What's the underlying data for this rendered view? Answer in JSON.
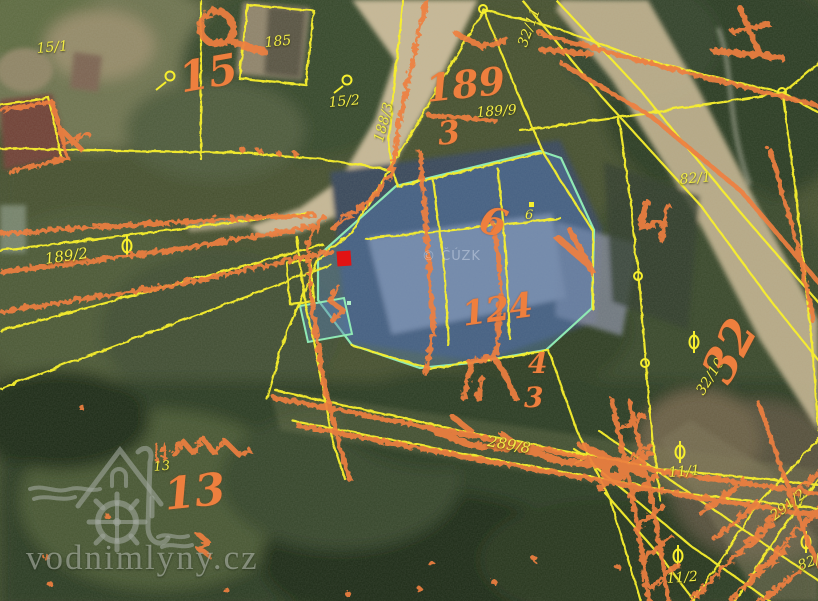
{
  "app": {
    "type": "aerial-cadastral-map-view",
    "watermark_site": "vodnimlyny.cz",
    "copyright": "© ČÚZK"
  },
  "colors": {
    "parcel_line_yellow": "#f7ef2e",
    "sketch_orange": "#ee7f40",
    "highlight_fill": "rgba(88,128,180,0.45)",
    "highlight_outline": "#8fe9b4",
    "marker_red": "#e11313",
    "road_tan": "#c6b795",
    "forest_green": "#2c3a20",
    "watermark_gray": "rgba(160,166,156,0.6)"
  },
  "marker": {
    "x": 337,
    "y": 251,
    "w": 14,
    "h": 15
  },
  "parcel_labels": [
    {
      "text": "15/1",
      "x": 36,
      "y": 42,
      "size": 14,
      "rot": -5
    },
    {
      "text": "185",
      "x": 264,
      "y": 36,
      "size": 14,
      "rot": -5
    },
    {
      "text": "15/2",
      "x": 328,
      "y": 96,
      "size": 14,
      "rot": -5
    },
    {
      "text": "188/3",
      "x": 372,
      "y": 140,
      "size": 14,
      "rot": -75
    },
    {
      "text": "189/9",
      "x": 476,
      "y": 106,
      "size": 14,
      "rot": -4
    },
    {
      "text": "189/2",
      "x": 44,
      "y": 252,
      "size": 15,
      "rot": -8
    },
    {
      "text": "82/1",
      "x": 679,
      "y": 173,
      "size": 14,
      "rot": -5
    },
    {
      "text": "32/11",
      "x": 516,
      "y": 44,
      "size": 14,
      "rot": -70
    },
    {
      "text": "32/10",
      "x": 694,
      "y": 390,
      "size": 14,
      "rot": -58
    },
    {
      "text": "11/1",
      "x": 668,
      "y": 466,
      "size": 14,
      "rot": -4
    },
    {
      "text": "11/2",
      "x": 666,
      "y": 572,
      "size": 14,
      "rot": -4
    },
    {
      "text": "291/2",
      "x": 768,
      "y": 512,
      "size": 14,
      "rot": -38
    },
    {
      "text": "289/8",
      "x": 489,
      "y": 434,
      "size": 15,
      "rot": 10
    },
    {
      "text": "13",
      "x": 153,
      "y": 461,
      "size": 13,
      "rot": -5
    },
    {
      "text": "6",
      "x": 525,
      "y": 209,
      "size": 13,
      "rot": 0
    },
    {
      "text": "82/1",
      "x": 796,
      "y": 560,
      "size": 14,
      "rot": -20
    }
  ],
  "sketch_labels": [
    {
      "text": "15",
      "x": 176,
      "y": 58,
      "size": 42,
      "rot": -10
    },
    {
      "text": "189",
      "x": 424,
      "y": 70,
      "size": 38,
      "rot": -6
    },
    {
      "text": "3",
      "x": 436,
      "y": 118,
      "size": 32,
      "rot": -6
    },
    {
      "text": "32",
      "x": 694,
      "y": 368,
      "size": 46,
      "rot": -62
    },
    {
      "text": "13",
      "x": 162,
      "y": 474,
      "size": 44,
      "rot": -6
    },
    {
      "text": "6",
      "x": 486,
      "y": 200,
      "size": 38,
      "rot": 16
    },
    {
      "text": "124",
      "x": 460,
      "y": 298,
      "size": 34,
      "rot": -8
    },
    {
      "text": "4",
      "x": 528,
      "y": 350,
      "size": 28,
      "rot": 0
    },
    {
      "text": "3",
      "x": 524,
      "y": 384,
      "size": 28,
      "rot": 0
    }
  ]
}
